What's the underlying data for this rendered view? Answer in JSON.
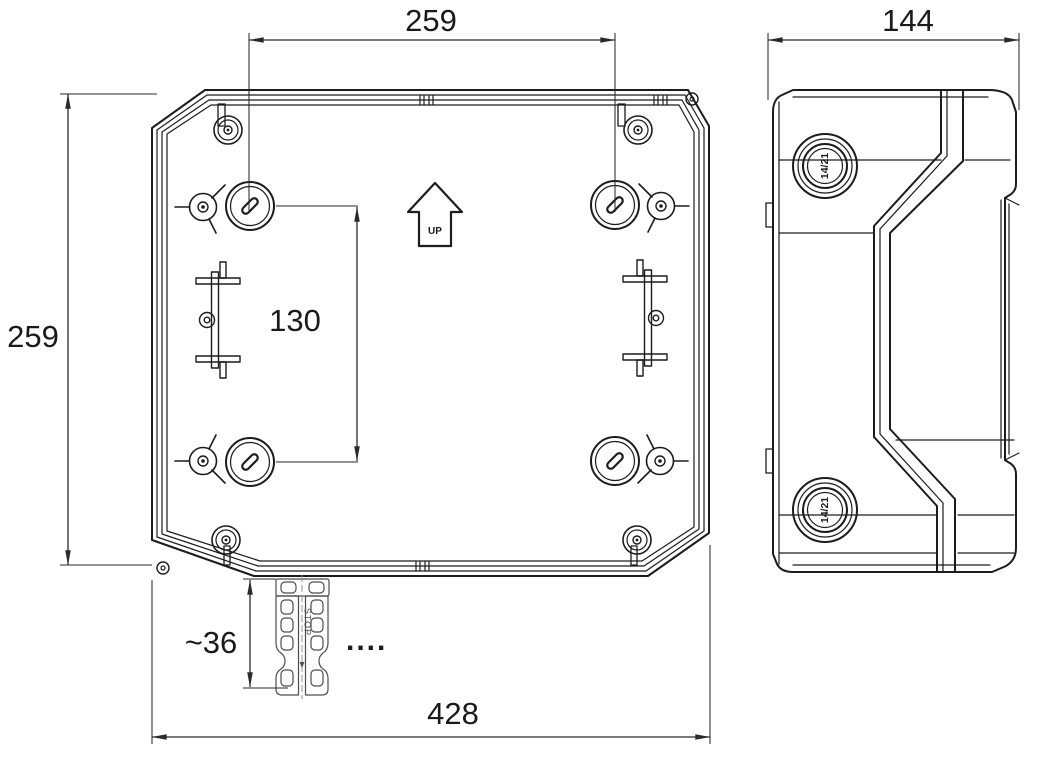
{
  "drawing": {
    "type": "enclosure-technical-drawing",
    "dims": {
      "top_hole_spacing": "259",
      "left_height": "259",
      "vertical_hole_spacing": "130",
      "bracket_height": "~36",
      "total_width": "428",
      "side_depth": "144"
    },
    "labels": {
      "up_arrow": "UP",
      "knockout_top": "14/21",
      "knockout_bottom": "14/21",
      "bracket_stop": "STOP",
      "continuation_dots": "...."
    },
    "colors": {
      "line": "#1c1c1c",
      "dimension": "#2a2a2a",
      "detail": "#4d4d4d",
      "background": "#ffffff"
    }
  }
}
